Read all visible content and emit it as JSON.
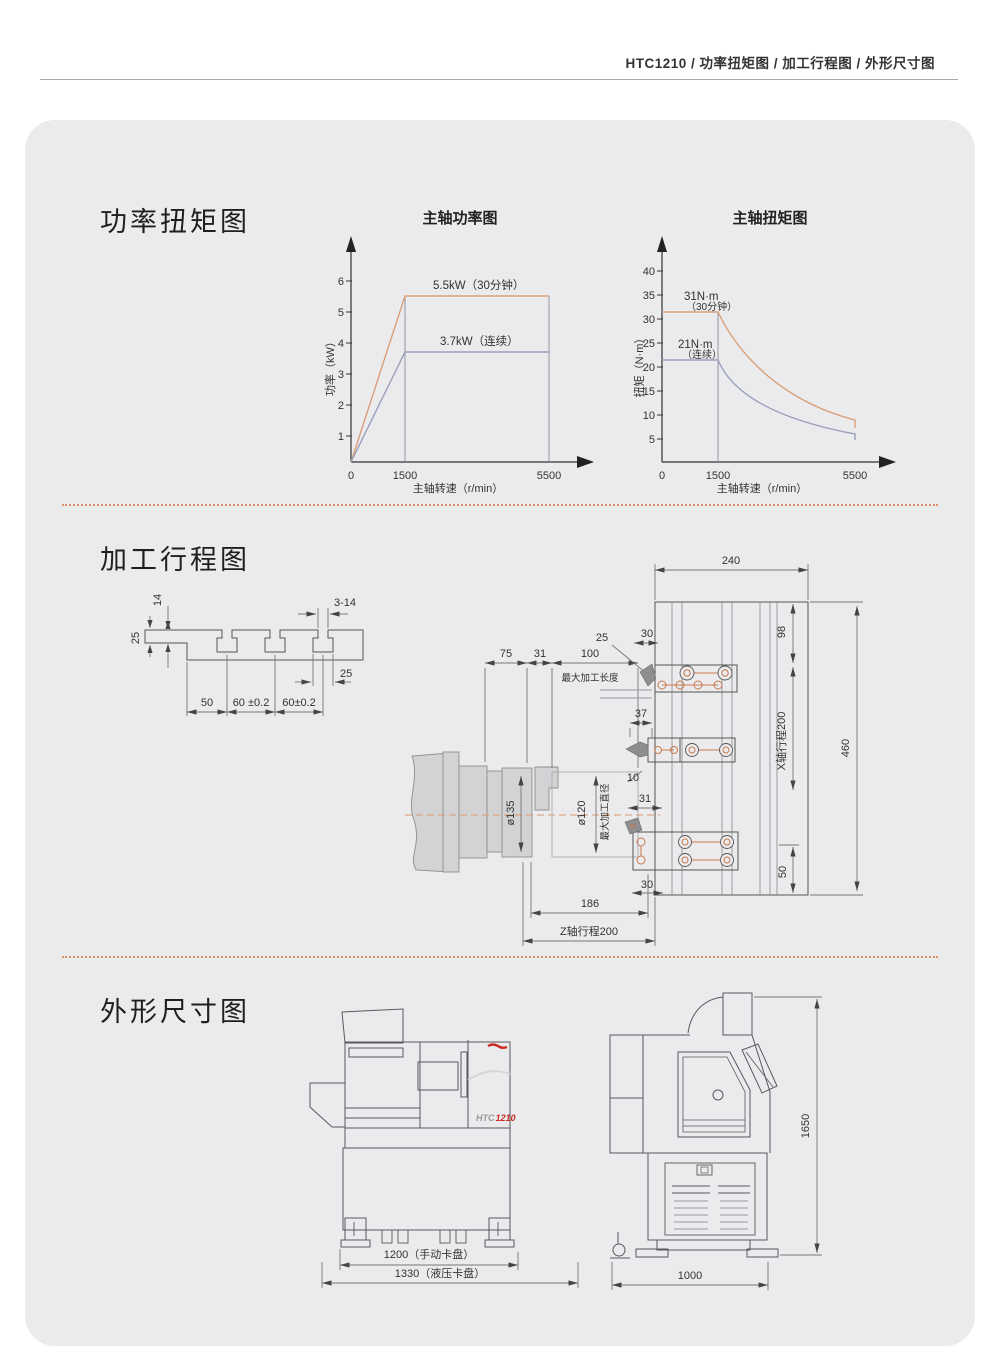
{
  "header": {
    "title": "HTC1210 / 功率扭矩图 / 加工行程图 / 外形尺寸图"
  },
  "sections": {
    "power": "功率扭矩图",
    "travel": "加工行程图",
    "outline": "外形尺寸图"
  },
  "chart_data": [
    {
      "type": "line",
      "title": "主轴功率图",
      "xlabel": "主轴转速（r/min）",
      "ylabel": "功率（kW）",
      "x_ticks": [
        "0",
        "1500",
        "5500"
      ],
      "y_ticks": [
        "1",
        "2",
        "3",
        "4",
        "5",
        "6"
      ],
      "xlim": [
        0,
        6200
      ],
      "ylim": [
        0,
        6.8
      ],
      "grid": false,
      "legend_position": "inline",
      "series": [
        {
          "name": "5.5kW（30分钟）",
          "color": "#d99f79",
          "x": [
            0,
            1500,
            5500
          ],
          "values": [
            0,
            5.5,
            5.5
          ]
        },
        {
          "name": "3.7kW（连续）",
          "color": "#9aa0bc",
          "x": [
            0,
            1500,
            5500
          ],
          "values": [
            0,
            3.7,
            3.7
          ]
        }
      ]
    },
    {
      "type": "line",
      "title": "主轴扭矩图",
      "xlabel": "主轴转速（r/min）",
      "ylabel": "扭矩（N·m）",
      "x_ticks": [
        "0",
        "1500",
        "5500"
      ],
      "y_ticks": [
        "5",
        "10",
        "15",
        "20",
        "25",
        "30",
        "35",
        "40"
      ],
      "xlim": [
        0,
        6200
      ],
      "ylim": [
        0,
        46
      ],
      "grid": false,
      "legend_position": "inline",
      "series": [
        {
          "name": "31N·m（30分钟）",
          "label1": "31N·m",
          "label2": "（30分钟）",
          "color": "#d99f79",
          "x": [
            0,
            1500,
            2500,
            4000,
            5500
          ],
          "values": [
            31.5,
            31.5,
            19,
            12,
            8.5
          ]
        },
        {
          "name": "21N·m（连续）",
          "label1": "21N·m",
          "label2": "（连续）",
          "color": "#9aa0bc",
          "x": [
            0,
            1500,
            2500,
            4000,
            5500
          ],
          "values": [
            21.5,
            21.5,
            13,
            8.5,
            6
          ]
        }
      ]
    }
  ],
  "travel": {
    "slot": {
      "d14": "14",
      "d25l": "25",
      "d314": "3-14",
      "d25r": "25",
      "d50": "50",
      "d60a": "60 ±0.2",
      "d60b": "60±0.2"
    },
    "spindle": {
      "d75": "75",
      "d31": "31",
      "d100": "100",
      "maxlen": "最大加工长度",
      "d25": "25",
      "d135": "ø135",
      "d120": "ø120",
      "maxdia": "最大加工直径"
    },
    "turret": {
      "d240": "240",
      "d30t": "30",
      "d37": "37",
      "d10": "10",
      "d31": "31",
      "d30b": "30",
      "d98": "98",
      "xtravel": "X轴行程200",
      "d460": "460",
      "d50": "50",
      "d186": "186",
      "ztravel": "Z轴行程200"
    }
  },
  "outline": {
    "front": {
      "model_prefix": "HTC",
      "model_number": "1210",
      "dim_width_manual": "1200（手动卡盘）",
      "dim_width_hydraulic": "1330（液压卡盘）"
    },
    "side": {
      "dim_height": "1650",
      "dim_depth": "1000"
    }
  },
  "colors": {
    "accent_orange": "#d99f79",
    "accent_blue": "#9aa0bc",
    "hole_orange": "#c8784e",
    "brand_red": "#cc2a22",
    "card_bg": "#ebebed"
  }
}
